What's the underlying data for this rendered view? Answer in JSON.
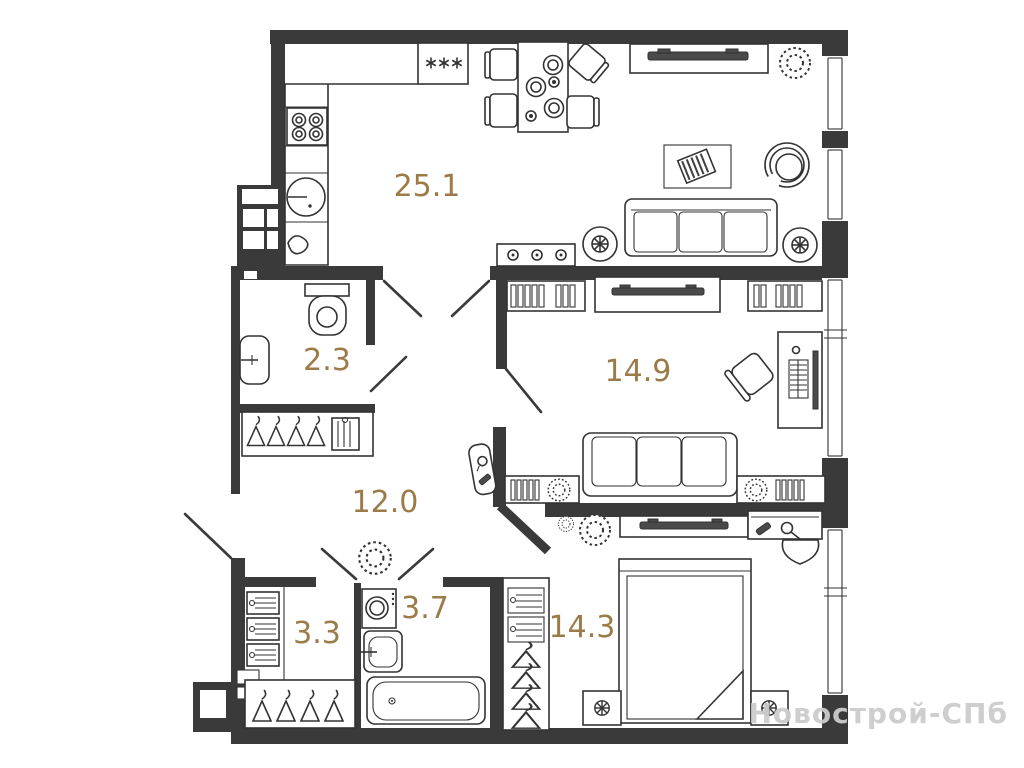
{
  "page": {
    "background": "#ffffff",
    "type": "apartment-floor-plan"
  },
  "watermark": {
    "text": "Новострой-СПб",
    "color": "#cccccc"
  },
  "colors": {
    "wall": "#3a3a3a",
    "furniture_line": "#333333",
    "room_label": "#9c7b49",
    "watermark": "#cccccc"
  },
  "rooms": [
    {
      "name": "kitchen-living-room",
      "area": "25.1"
    },
    {
      "name": "bathroom-small",
      "area": "2.3"
    },
    {
      "name": "bedroom",
      "area": "14.9"
    },
    {
      "name": "hallway",
      "area": "12.0"
    },
    {
      "name": "closet",
      "area": "3.3"
    },
    {
      "name": "bathroom",
      "area": "3.7"
    },
    {
      "name": "bedroom-master",
      "area": "14.3"
    }
  ]
}
